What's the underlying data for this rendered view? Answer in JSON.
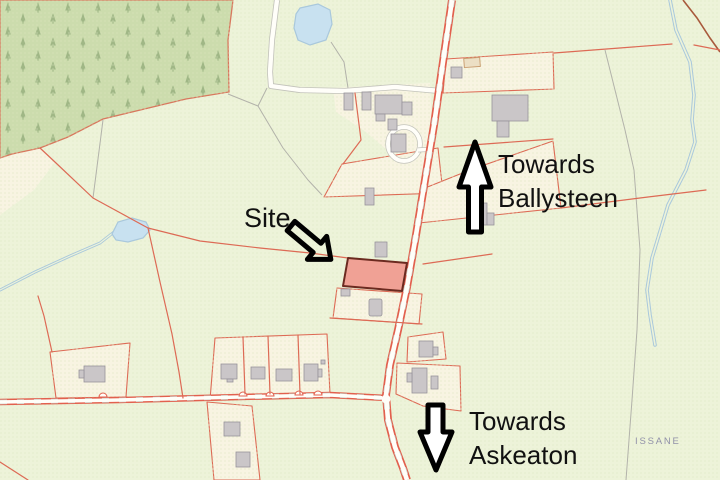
{
  "annotations": {
    "site_label": "Site",
    "ballysteen": {
      "line1": "Towards",
      "line2": "Ballysteen",
      "direction": "up"
    },
    "askeaton": {
      "line1": "Towards",
      "line2": "Askeaton",
      "direction": "down"
    },
    "townland_label": "ISSANE"
  },
  "map_features": {
    "site_plot": "highlighted red/pink parcel beside the main road",
    "site_arrow": "black outline arrow pointing down-right at the site plot",
    "forest": "conifer plantation, top-left",
    "ponds": 2,
    "streams": 2,
    "main_road": "runs top to bottom, right of centre",
    "minor_road": "runs along the bottom, left to the junction"
  },
  "colors": {
    "map-bg": "#edf3d9",
    "forest-fill": "#ccdcad",
    "parcel-fill": "#f8f4e2",
    "site-fill": "#f0a195",
    "site-border": "#6b2a20",
    "boundary-line": "#dd6a55",
    "gray-line": "#b2b2aa",
    "road-fill": "#fffef9",
    "road-edge": "#e2604e",
    "track-edge": "#c2c2ba",
    "water-fill": "#c8e1f0",
    "water-line": "#a9c8dc",
    "building-fill": "#cac6c8",
    "building-edge": "#97939a",
    "annotation": "#111111",
    "townland-text": "#9191a9"
  }
}
